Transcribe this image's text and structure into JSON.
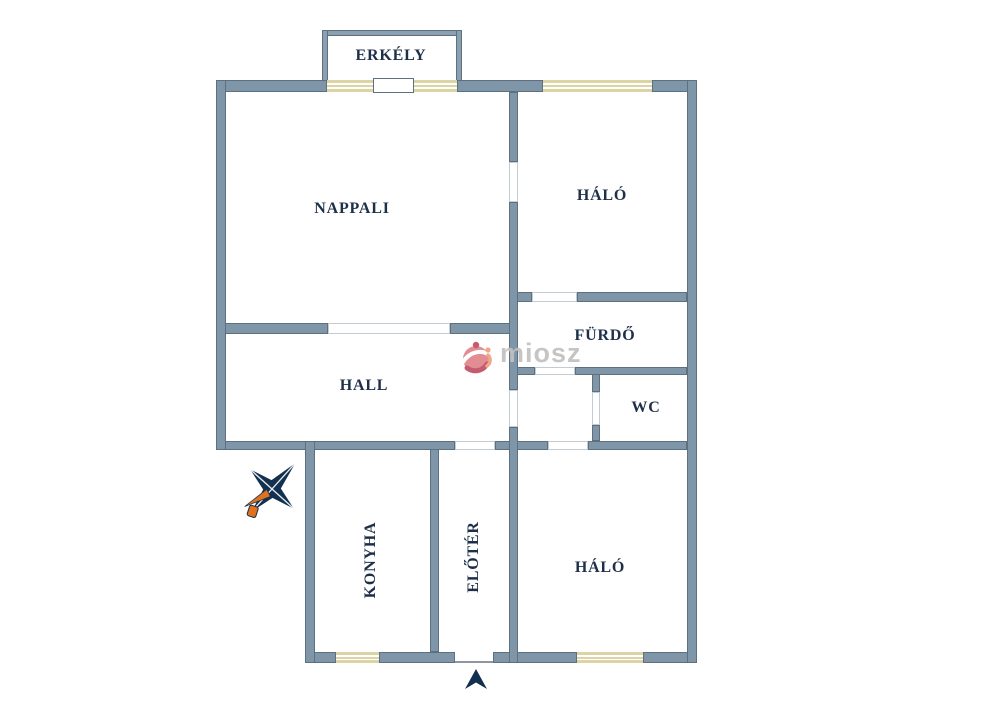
{
  "plan": {
    "type": "floor-plan",
    "watermark": {
      "brand": "miosz"
    },
    "rooms": [
      {
        "id": "erkely",
        "label": "ERKÉLY",
        "orientation": "horizontal"
      },
      {
        "id": "nappali",
        "label": "NAPPALI",
        "orientation": "horizontal"
      },
      {
        "id": "halo-top",
        "label": "HÁLÓ",
        "orientation": "horizontal"
      },
      {
        "id": "furdo",
        "label": "FÜRDŐ",
        "orientation": "horizontal"
      },
      {
        "id": "wc",
        "label": "WC",
        "orientation": "horizontal"
      },
      {
        "id": "hall",
        "label": "HALL",
        "orientation": "horizontal"
      },
      {
        "id": "konyha",
        "label": "KONYHA",
        "orientation": "vertical"
      },
      {
        "id": "eloter",
        "label": "ELŐTÉR",
        "orientation": "vertical"
      },
      {
        "id": "halo-bottom",
        "label": "HÁLÓ",
        "orientation": "horizontal"
      }
    ]
  },
  "colors": {
    "wall_fill": "#7e96a8",
    "wall_stroke": "#5c7080",
    "balcony_fill": "#8ba0b0",
    "label": "#1e3048",
    "window_frame": "#ddd4a6",
    "door_outline": "#c3ccd3",
    "threshold": "#8f979e",
    "watermark_text": "#c1c1c1",
    "logo_pink": "#e0848c",
    "logo_dark_pink": "#c14e62",
    "logo_salmon": "#efa07f",
    "compass_navy": "#133050",
    "compass_orange": "#e2711d"
  }
}
